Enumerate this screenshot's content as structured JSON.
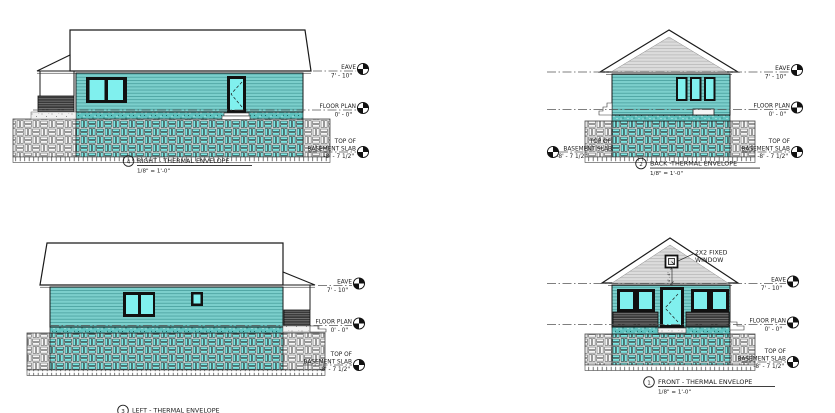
{
  "views": {
    "right": {
      "number": "4",
      "title": "RIGHT - THERMAL ENVELOPE",
      "scale": "1/8\" = 1'-0\""
    },
    "back": {
      "number": "2",
      "title": "BACK -THERMAL ENVELOPE",
      "scale": "1/8\" = 1'-0\""
    },
    "left": {
      "number": "3",
      "title": "LEFT - THERMAL ENVELOPE"
    },
    "front": {
      "number": "1",
      "title": "FRONT - THERMAL ENVELOPE",
      "scale": "1/8\" = 1'-0\""
    }
  },
  "levels": {
    "eave": {
      "label": "EAVE",
      "value": "7' - 10\""
    },
    "floor_plan": {
      "label": "FLOOR PLAN",
      "value": "0' - 0\""
    },
    "basement_slab": {
      "label_line1": "TOP OF",
      "label_line2": "BASEMENT SLAB",
      "value": "-8' - 7 1/2\""
    }
  },
  "annotations": {
    "gable_window_callout_line1": "2X2 FIXED",
    "gable_window_callout_line2": "WINDOW",
    "gable_window_dimension": "4' - 4\""
  },
  "colors": {
    "wall_teal": "#7CCFCC",
    "wall_seam": "#4FA5A3",
    "window_glass": "#80F0EE",
    "foundation_block_teal": "#7EE6E3",
    "gable_siding_gray": "#DCDCDC",
    "line_ink": "#1A1A1A"
  }
}
